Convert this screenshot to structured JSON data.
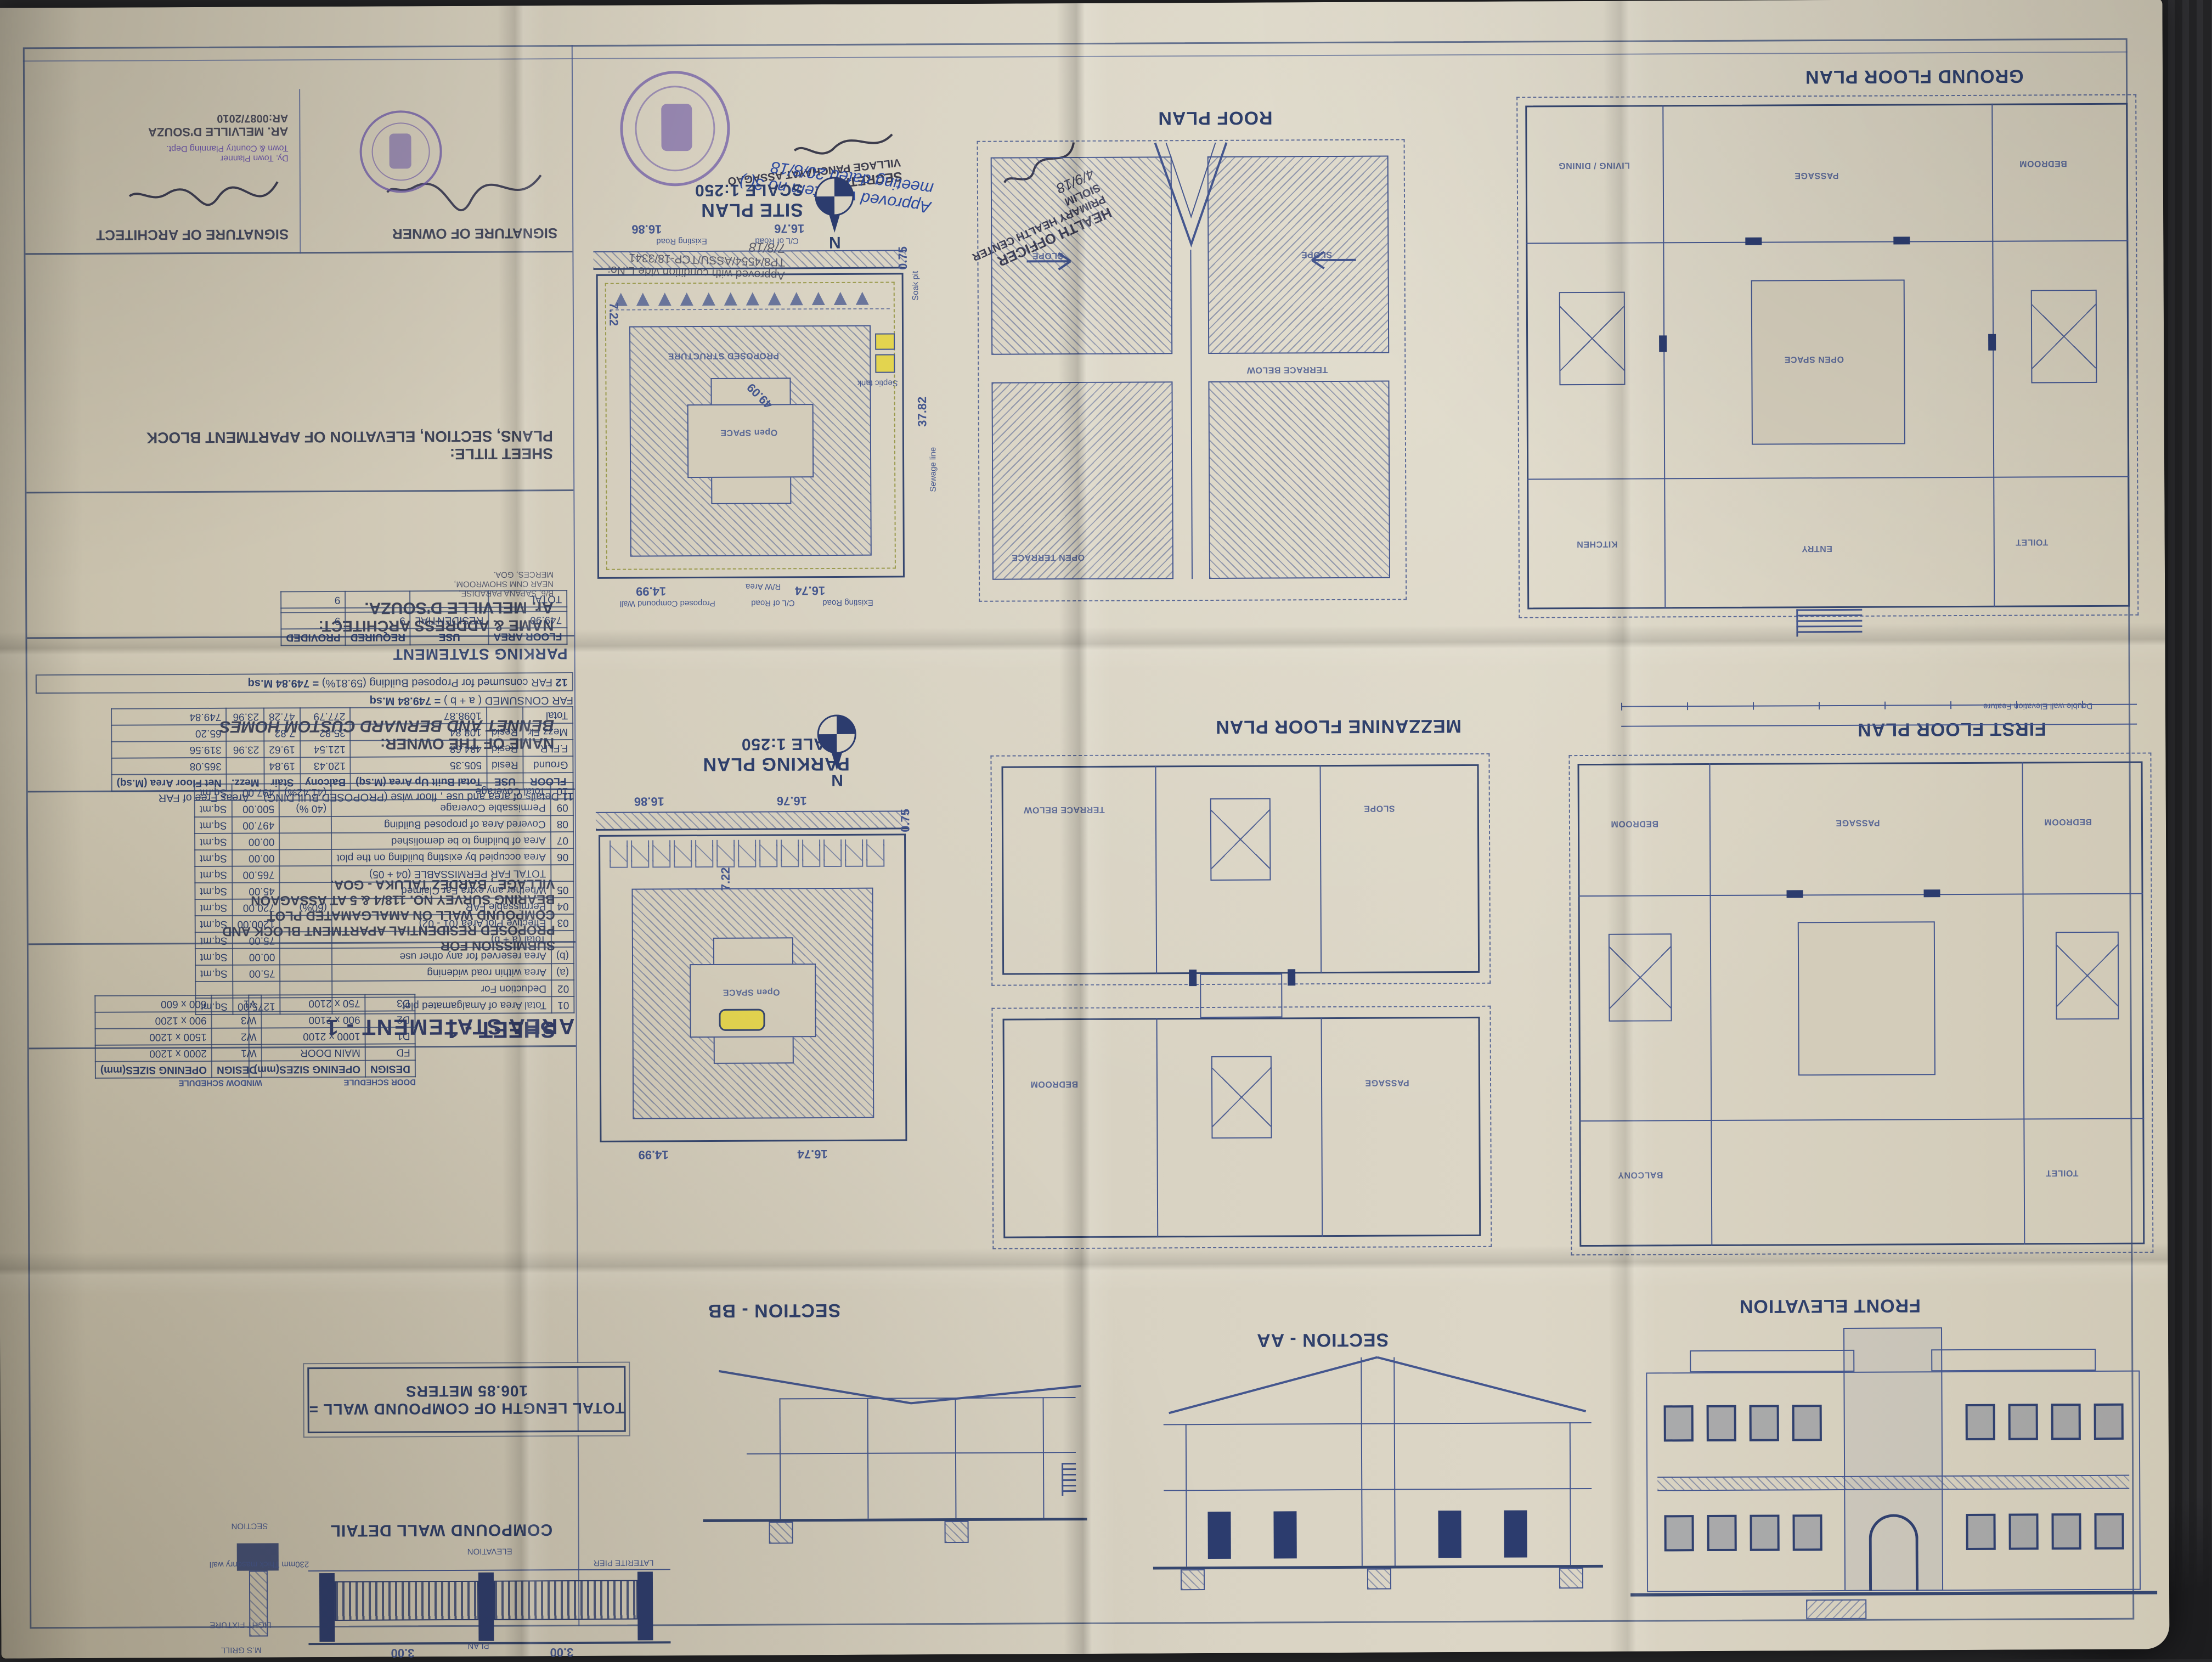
{
  "sheet": {
    "sheet_no": "SHEET - 1",
    "title_block": {
      "signature_owner_label": "SIGNATURE OF OWNER",
      "signature_architect_label": "SIGNATURE OF ARCHITECT",
      "architect_stamp_line1": "AR. MELVILLE D'SOUZA",
      "architect_stamp_line2": "AR:0087/2010",
      "sheet_title_label": "SHEET TITLE:",
      "sheet_title": "PLANS, SECTION, ELEVATION OF APARTMENT BLOCK",
      "architect_label": "NAME & ADDRESS ARCHITECT:",
      "architect_name": "Ar. MELVILLE D'SOUZA.",
      "architect_address_line1": "B/6, SAPANA PARADISE,",
      "architect_address_line2": "NEAR CNM SHOWROOM,",
      "architect_address_line3": "MERCES, GOA.",
      "owner_label": "NAME OF THE OWNER:",
      "owner_name": "BENNET AND BERNARD CUSTOM HOMES",
      "submission_label": "SUBMISSION FOR",
      "submission_line1": "PROPOSED RESIDENTIAL APARTMENT BLOCK AND",
      "submission_line2": "COMPOUND WALL ON AMALGAMATED PLOT",
      "submission_line3": "BEARING SURVEY NO. 118/4 & 5  AT ASSAGAON",
      "submission_line4": "VILLAGE , BARDEZ TALUKA - GOA."
    },
    "approvals": {
      "panchayat_note_line1": "Approved vide item no 3(.)",
      "panchayat_note_line2": "meeting dated 20/8/18",
      "secretary_line1": "SECRETARY",
      "secretary_line2": "VILLAGE PANCHAYAT ASSAGAO",
      "tcp_note": "Approved with condition vide L.No: TP8/4554/ASSU/TCP-18/3341",
      "tcp_date": "7/8/18",
      "tcp_officer_line1": "Dy. Town Planner",
      "tcp_officer_line2": "Town & Country Planning Dept.",
      "health_line1": "HEALTH OFFICER",
      "health_line2": "PRIMARY HEALTH CENTER",
      "health_line3": "SIOLIM",
      "health_date": "4/9/18"
    },
    "tables": {
      "parking_statement": {
        "title": "PARKING STATEMENT",
        "headers": [
          "FLOOR AREA",
          "USE",
          "REQUIRED",
          "PROVIDED"
        ],
        "rows": [
          [
            "749.90",
            "RESIDENTIAL",
            "9",
            "9"
          ],
          [
            "",
            "",
            "",
            ""
          ],
          [
            "TOTAL",
            "",
            "",
            "9"
          ]
        ]
      },
      "floorwise": {
        "no": "11",
        "title": "Details of area and use , floor wise  (PROPOSED BUILDING)",
        "headers": [
          "FLOOR",
          "USE",
          "Total Built Up Area (M.sq)",
          "Balcony",
          "Stair",
          "Mezz.",
          "Net Floor Area (M.sq)"
        ],
        "free_far_label": "Areas Free of FAR",
        "rows": [
          [
            "Ground",
            "Resid",
            "505.35",
            "120.43",
            "19.84",
            "",
            "365.08"
          ],
          [
            "F.FLR.",
            "Resid",
            "484.68",
            "121.54",
            "19.62",
            "23.96",
            "319.56"
          ],
          [
            "Mezz Flr",
            "Resid",
            "108.84",
            "35.82",
            "7.82",
            "",
            "65.20"
          ],
          [
            "Total",
            "",
            "1098.87",
            "277.79",
            "47.28",
            "23.96",
            "749.84"
          ]
        ],
        "far_consumed_label": "FAR CONSUMED ( a + b )",
        "far_consumed_value": "= 749.84 M.sq"
      },
      "far_note": {
        "no": "12",
        "text": "FAR consumed for Proposed Building",
        "pct": "(59.81%)",
        "value": "= 749.84 M.sq"
      },
      "area_statement": {
        "title": "AREA STATEMENT - 1",
        "rows": [
          [
            "01",
            "Total Area of Amalgamated plot",
            "",
            "1275.00",
            "Sq.mt"
          ],
          [
            "02",
            "Deduction For",
            "",
            "",
            ""
          ],
          [
            "(a)",
            "Area within road widening",
            "",
            "75.00",
            "Sq.mt"
          ],
          [
            "(b)",
            "Area reserved for any other use",
            "",
            "00.00",
            "Sq.mt"
          ],
          [
            "",
            "Total (a + b)",
            "",
            "75.00",
            "Sq.mt"
          ],
          [
            "03",
            "Effective Plot Area (01 - 02)",
            "",
            "1200.00",
            "Sq.mt"
          ],
          [
            "04",
            "Permissable FAR",
            "(60%)",
            "720.00",
            "Sq.mt"
          ],
          [
            "05",
            "Whether any extra Far Claimed",
            "",
            "45.00",
            "Sq.mt"
          ],
          [
            "",
            "TOTAL FAR PERMISSABLE (04 + 05)",
            "",
            "765.00",
            "Sq.mt"
          ],
          [
            "06",
            "Area occupied by existing building on the plot",
            "",
            "00.00",
            "Sq.mt"
          ],
          [
            "07",
            "Area of building to be demolished",
            "",
            "00.00",
            "Sq.mt"
          ],
          [
            "08",
            "Covered Area of proposed Building",
            "",
            "497.00",
            "Sq.mt"
          ],
          [
            "09",
            "Permissable Coverage",
            "(40 %)",
            "500.00",
            "Sq.mt"
          ],
          [
            "10",
            "Total Coverage",
            "(41.42%)",
            "497.00",
            "Sq.mt"
          ]
        ]
      },
      "window_schedule": {
        "title": "WINDOW SCHEDULE",
        "headers": [
          "DESIGN",
          "OPENING SIZES(mm)"
        ],
        "rows": [
          [
            "W1",
            "2000 x 1200"
          ],
          [
            "W2",
            "1500 x 1200"
          ],
          [
            "W3",
            "900 x 1200"
          ],
          [
            "V1",
            "600 x 600"
          ]
        ]
      },
      "door_schedule": {
        "title": "DOOR SCHEDULE",
        "headers": [
          "DESIGN",
          "OPENING SIZES(mm)"
        ],
        "rows": [
          [
            "FD",
            "MAIN DOOR"
          ],
          [
            "D1",
            "1000 x 2100"
          ],
          [
            "D2",
            "900 x 2100"
          ],
          [
            "D3",
            "750 x 2100"
          ]
        ]
      }
    },
    "plans": {
      "site": {
        "title": "SITE PLAN",
        "scale": "SCALE 1:250",
        "north": "N",
        "dim_top_left": "16.86",
        "dim_top_right": "16.76",
        "dim_right_top": "0.75",
        "dim_right": "37.82",
        "dim_bottom_left": "14.99",
        "dim_bottom_right": "16.74",
        "dim_diag": "49.09",
        "dim_setback": "7.22",
        "label_structure": "PROPOSED STRUCTURE",
        "label_open": "Open SPACE",
        "label_road": "Existing Road",
        "label_cl": "C/L of Road",
        "label_rw": "R/W Area",
        "label_wall": "Proposed Compound Wall",
        "label_sewage": "Sewage line",
        "label_septic": "Septic tank",
        "label_soak": "Soak pit"
      },
      "parking": {
        "title": "PARKING PLAN",
        "scale": "SCALE 1:250",
        "north": "N"
      },
      "roof": {
        "title": "ROOF PLAN",
        "label_slope": "SLOPE",
        "label_terrace": "OPEN TERRACE",
        "label_below": "TERRACE BELOW"
      },
      "ground": {
        "title": "GROUND FLOOR PLAN",
        "label_open": "OPEN SPACE"
      },
      "mezzanine": {
        "title": "MEZZANINE FLOOR PLAN"
      },
      "first": {
        "title": "FIRST FLOOR PLAN",
        "label_feature": "Double wall Elevation Feature"
      },
      "section_bb": {
        "title": "SECTION - BB"
      },
      "section_aa": {
        "title": "SECTION - AA"
      },
      "front": {
        "title": "FRONT ELEVATION"
      },
      "compound": {
        "title": "COMPOUND WALL DETAIL",
        "total_line1": "TOTAL LENGTH OF COMPOUND WALL =",
        "total_line2": "106.85 METERS",
        "label_elevation": "ELEVATION",
        "label_section": "SECTION",
        "label_plan": "PLAN",
        "label_masonry": "230mm Thick masonry wall",
        "label_grill": "M.S GRILL",
        "label_pier": "LATERITE PIER",
        "label_light": "LIGHT FIXTURE",
        "label_rubble": "Rubble Soling",
        "dim_bay": "3.00"
      }
    },
    "rooms": [
      "LIVING / DINING",
      "BEDROOM",
      "KITCHEN",
      "TOILET",
      "PASSAGE",
      "STAIR",
      "BALCONY",
      "ENTRY",
      "DECK",
      "OPEN TERRACE",
      "TERRACE BELOW",
      "SLOPE"
    ],
    "colors": {
      "ink": "#44568e",
      "paper": "#d3ccba",
      "stamp_purple": "#6a55a5",
      "highlight_yellow": "#e3d44f",
      "pen_blue": "#2b49a0"
    }
  }
}
